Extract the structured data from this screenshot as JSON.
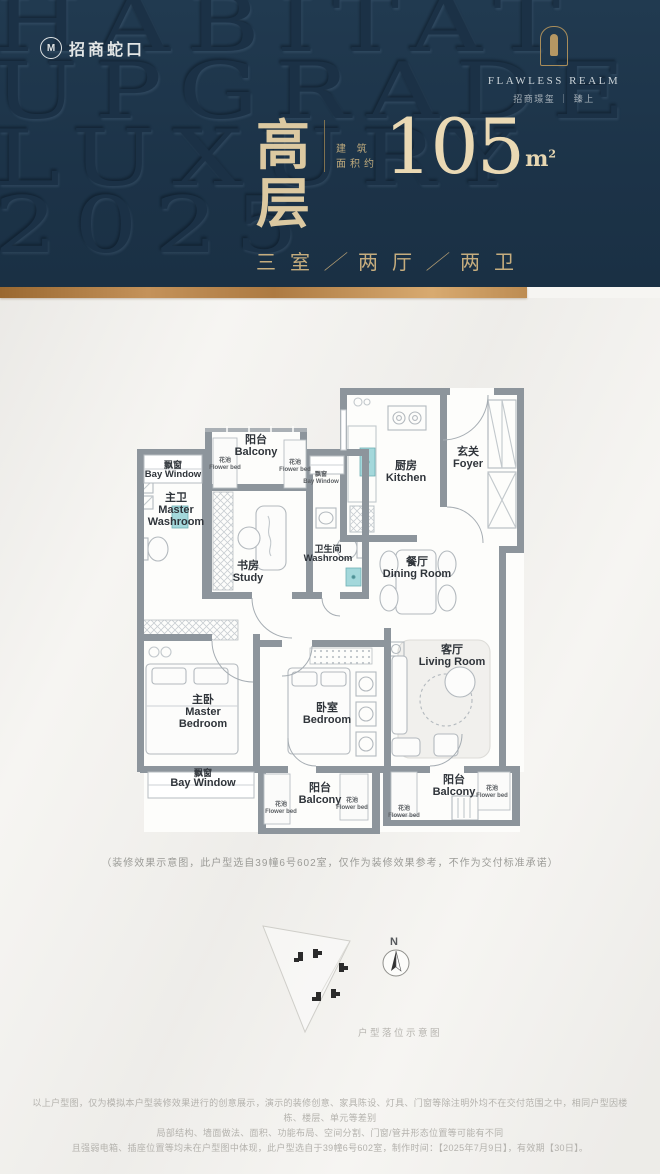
{
  "header": {
    "logo_left": {
      "icon_letter": "M",
      "text": "招商蛇口"
    },
    "watermark": [
      "HABITAT",
      "UPGRADE",
      "LUXURY",
      "2025"
    ],
    "logo_right": {
      "name_en": "FLAWLESS REALM",
      "name_cn": "招商璟玺 ｜ 臻上"
    }
  },
  "title": {
    "headline": "高层",
    "area_label_line1": "建 筑",
    "area_label_line2": "面积约",
    "area_value": "105",
    "area_unit": "m",
    "area_unit_exp": "2",
    "spec": {
      "rooms": "三室",
      "divider": "／",
      "halls": "两厅",
      "baths": "两卫"
    }
  },
  "floorplan": {
    "rooms": {
      "balcony_top": {
        "cn": "阳台",
        "en": "Balcony"
      },
      "bay_window_left": {
        "cn": "飘窗",
        "en": "Bay Window"
      },
      "master_washroom": {
        "cn": "主卫",
        "en": "Master Washroom"
      },
      "bay_window_small": {
        "cn": "飘窗",
        "en": "Bay Window"
      },
      "kitchen": {
        "cn": "厨房",
        "en": "Kitchen"
      },
      "foyer": {
        "cn": "玄关",
        "en": "Foyer"
      },
      "study": {
        "cn": "书房",
        "en": "Study"
      },
      "washroom": {
        "cn": "卫生间",
        "en": "Washroom"
      },
      "dining": {
        "cn": "餐厅",
        "en": "Dining Room"
      },
      "living": {
        "cn": "客厅",
        "en": "Living Room"
      },
      "master_bedroom": {
        "cn": "主卧",
        "en": "Master Bedroom"
      },
      "bedroom": {
        "cn": "卧室",
        "en": "Bedroom"
      },
      "bay_window_bottom": {
        "cn": "飘窗",
        "en": "Bay Window"
      },
      "balcony_bottom": {
        "cn": "阳台",
        "en": "Balcony"
      },
      "balcony_right": {
        "cn": "阳台",
        "en": "Balcony"
      }
    },
    "labels": {
      "flower_bed": {
        "cn": "花池",
        "en": "Flower bed"
      }
    },
    "caption": "（装修效果示意图，此户型选自39幢6号602室，仅作为装修效果参考，不作为交付标准承诺）"
  },
  "siteplan": {
    "north": "N",
    "caption": "户型落位示意图"
  },
  "footer": {
    "line1": "以上户型图，仅为模拟本户型装修效果进行的创意展示，演示的装修创意、家具陈设、灯具、门窗等除注明外均不在交付范围之中，相同户型因楼栋、楼层、单元等差别",
    "line2": "局部结构、墙面做法、面积、功能布局、空间分割、门窗/管井形态位置等可能有不同",
    "line3": "且强弱电箱、插座位置等均未在户型图中体现，此户型选自于39幢6号602室，制作时间：【2025年7月9日】，有效期【30日】。"
  },
  "colors": {
    "navy": "#1d3549",
    "gold_bar": "#c28e55",
    "gold_text": "#d5c096",
    "fixture_teal": "#a4d8db"
  }
}
